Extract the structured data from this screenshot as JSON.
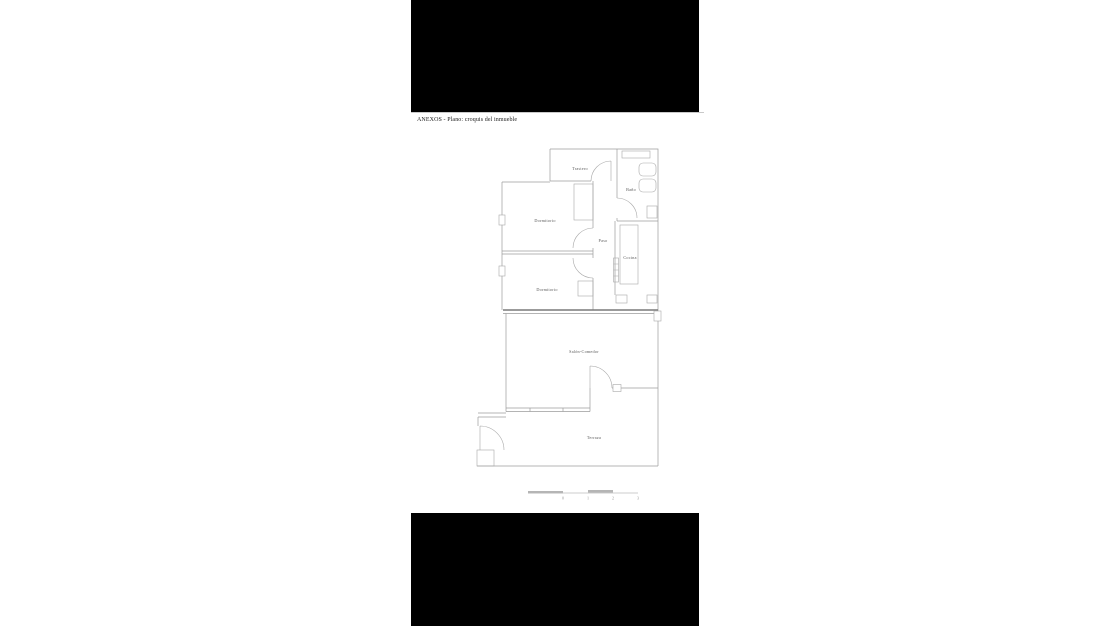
{
  "page": {
    "title": "ANEXOS - Plano: croquis del inmueble"
  },
  "floorplan": {
    "rooms": [
      {
        "label": "Trastero"
      },
      {
        "label": "Baño"
      },
      {
        "label": "Dormitorio"
      },
      {
        "label": "Paso"
      },
      {
        "label": "Cocina"
      },
      {
        "label": "Dormitorio"
      },
      {
        "label": "Salón-Comedor"
      },
      {
        "label": "Terraza"
      }
    ],
    "scale_bar": {
      "labels": [
        "0",
        "1",
        "2",
        "3"
      ]
    },
    "colors": {
      "wall": "#9c9c9c",
      "wall_bold": "#7a7a7a",
      "label": "#5a5a5a",
      "letterbox": "#000000",
      "background": "#ffffff"
    }
  }
}
